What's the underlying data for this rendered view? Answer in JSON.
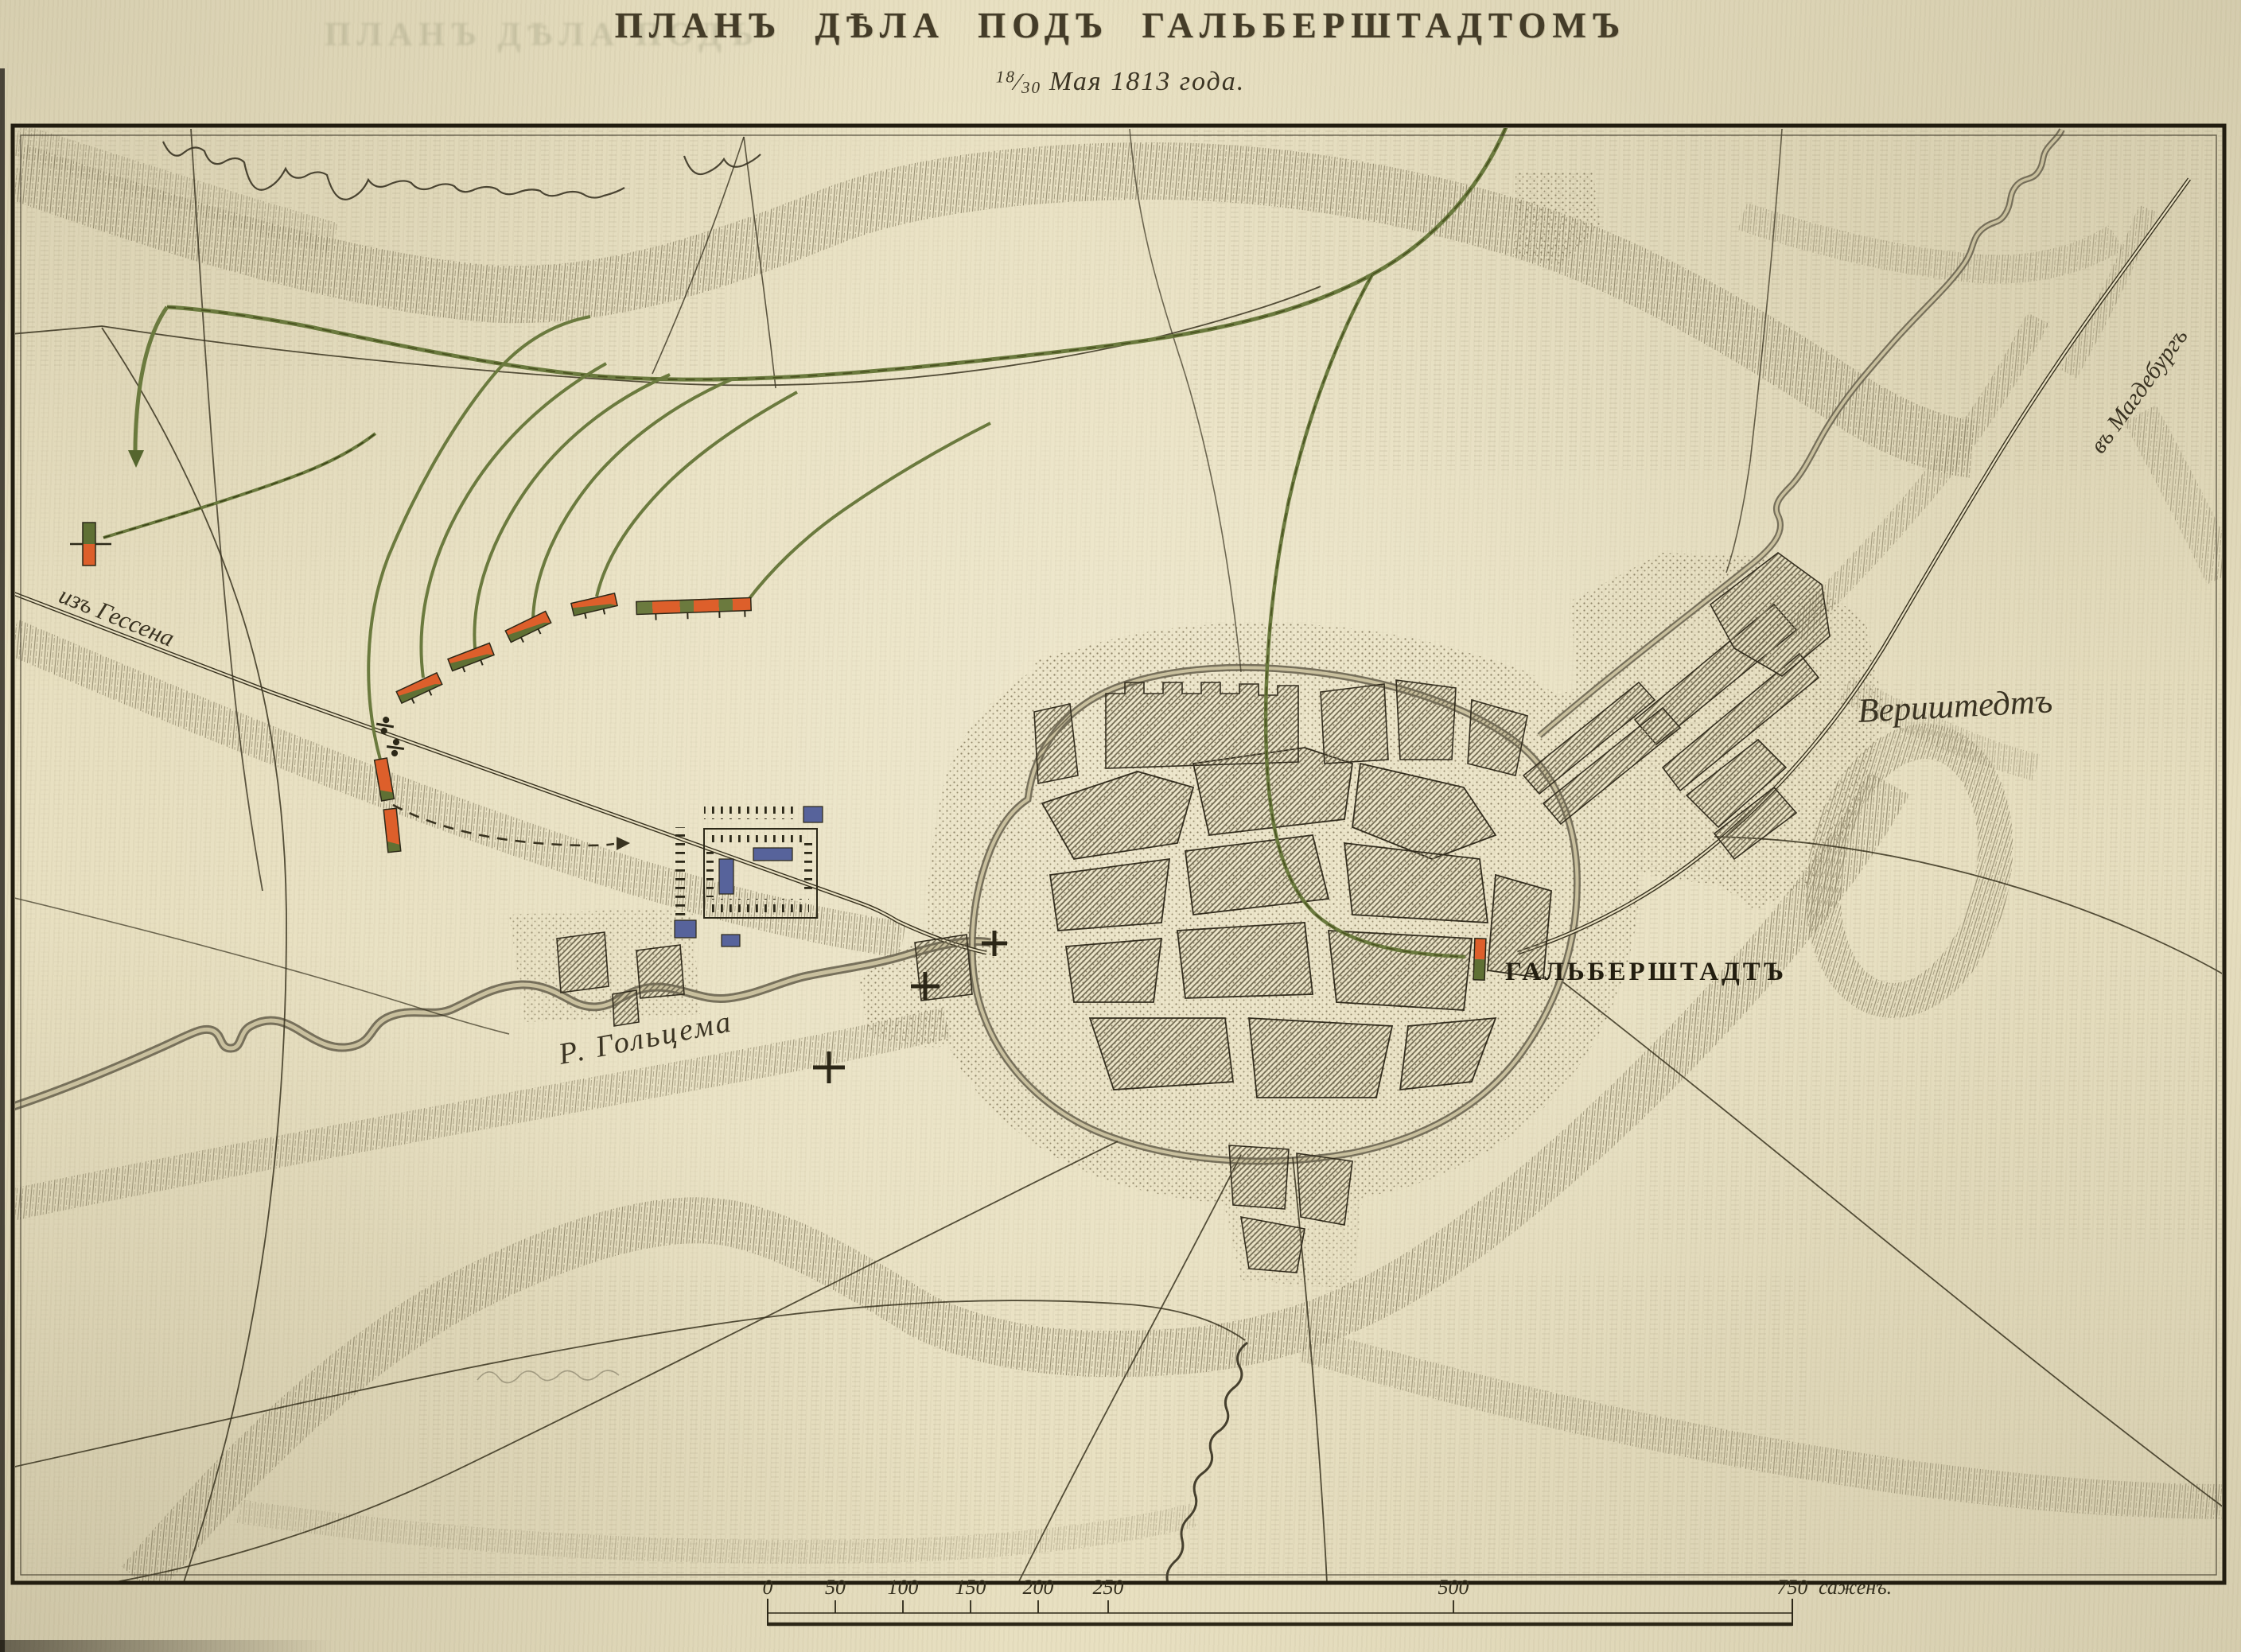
{
  "page": {
    "title": "ПЛАНЪ ДѢЛА ПОДЪ ГАЛЬБЕРШТАДТОМЪ",
    "date": {
      "day_julian": "18",
      "day_gregorian": "30",
      "text": "Мая 1813 года."
    },
    "ghost_title": "ПЛАНЪ ДѢЛА ПОДЪ"
  },
  "map": {
    "labels": {
      "road_from_hessen": "изъ Гессена",
      "road_to_magdeburg": "въ Магдебургъ",
      "river": "Р. Гольцема",
      "city": "ГАЛЬБЕРШТАДТЪ",
      "village": "Вериштедтъ"
    },
    "scale_bar": {
      "tick_labels": [
        "0",
        "50",
        "100",
        "150",
        "200",
        "250",
        "500",
        "750"
      ],
      "unit_label": "саженъ."
    },
    "legend_colors": {
      "paper": "#e9e1c2",
      "ink": "#35301f",
      "hachure": "#8a8165",
      "river": "#6a6450",
      "route_green": "#6b7a3e",
      "unit_orange": "#dd5f2b",
      "unit_green": "#5f7034",
      "camp_blue": "#57639b",
      "town_hatch": "#6f6850",
      "stipple": "#8f8568"
    }
  }
}
